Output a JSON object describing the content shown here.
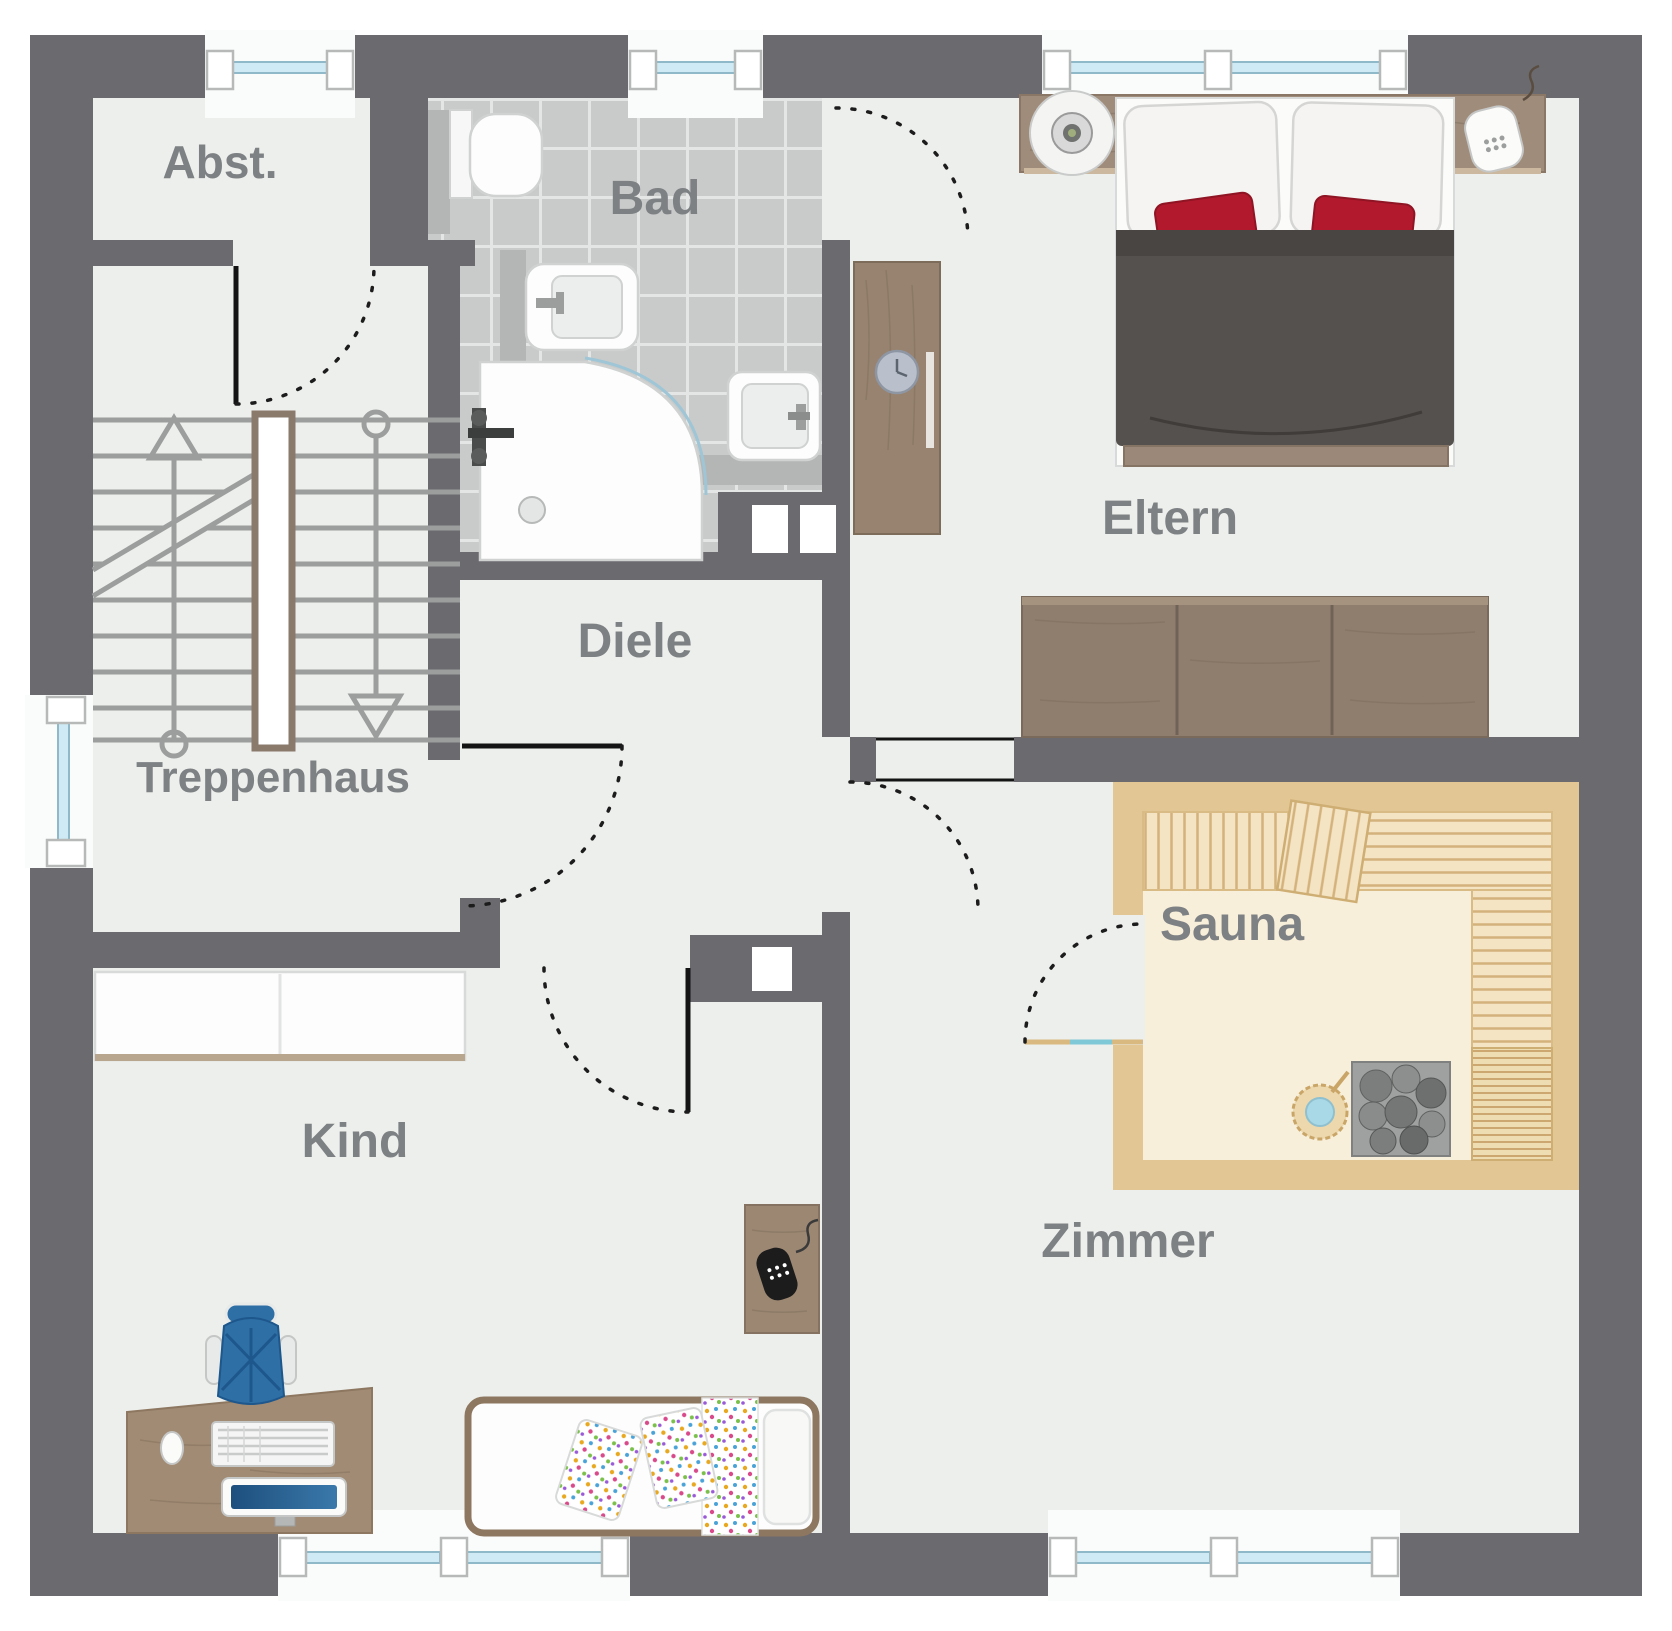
{
  "rooms": {
    "abst": "Abst.",
    "bad": "Bad",
    "eltern": "Eltern",
    "treppenhaus": "Treppenhaus",
    "diele": "Diele",
    "sauna": "Sauna",
    "kind": "Kind",
    "zimmer": "Zimmer"
  },
  "colors": {
    "wall": "#6a6a6f",
    "floor": "#edefec",
    "tile": "#c9cbca",
    "grout": "#e4e6e5",
    "sauna_wall": "#e2c795",
    "sauna_floor": "#f8efda",
    "bench": "#f4e4c4",
    "bench_line": "#d4b27c",
    "wood_dark": "#8f7d6d",
    "wood_mid": "#9c8772",
    "wood_light": "#a28b74",
    "headboard_wood": "#a08c7a",
    "glass": "#cfeaf4",
    "glass_frame": "#8fb9c9",
    "duvet": "#55514e",
    "pillow_red": "#b3192d",
    "chair_blue": "#2e6fa6",
    "label": "#7e8184",
    "railing": "#9b9e9d"
  },
  "windows": {
    "top_wall": 3,
    "bottom_wall": 2,
    "left_wall": 1
  },
  "icons": [
    "toilet-icon",
    "bidet-icon",
    "bathtub-icon",
    "sink-icon",
    "double-bed",
    "white-pillow",
    "red-pillow",
    "bedside-lamp-icon",
    "phone-icon",
    "wardrobe",
    "sideboard",
    "clock-icon",
    "sauna-bench",
    "sauna-backrest",
    "sauna-heater-icon",
    "sauna-bucket-icon",
    "closet",
    "desk",
    "office-chair",
    "keyboard-icon",
    "monitor-icon",
    "mouse-icon",
    "single-bed",
    "nightstand",
    "mobile-phone-icon",
    "stairs",
    "up-arrow-icon",
    "down-arrow-icon",
    "door-swing-arc",
    "window",
    "duct"
  ]
}
